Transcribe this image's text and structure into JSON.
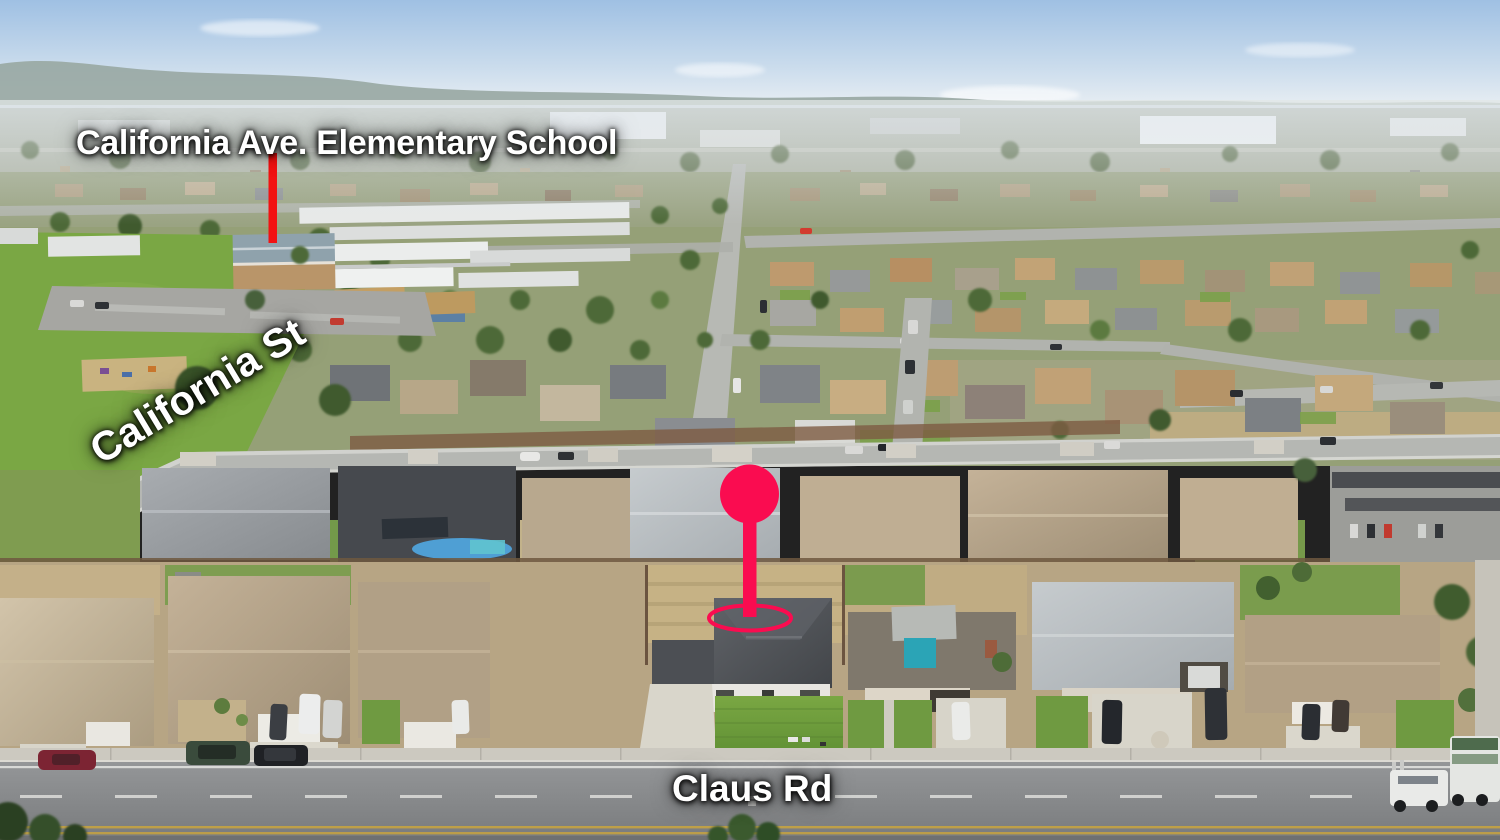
{
  "annotations": {
    "school_label": "California Ave. Elementary School",
    "street_label_diagonal": "California St",
    "street_label_bottom": "Claus Rd"
  },
  "marker": {
    "pin_color": "#FA0C50",
    "pointer_line_color": "#F21212"
  }
}
